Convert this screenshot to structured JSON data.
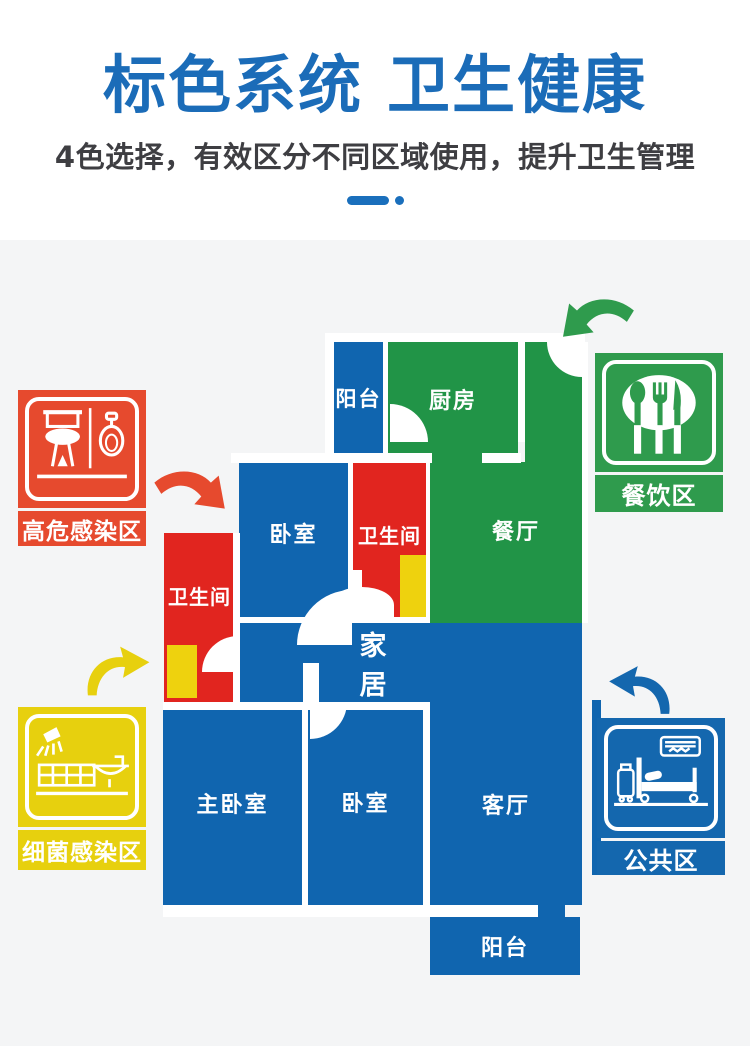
{
  "header": {
    "title": "标色系统 卫生健康",
    "subtitle": "4色选择，有效区分不同区域使用，提升卫生管理"
  },
  "colors": {
    "page_bg": "#ffffff",
    "section_bg": "#f4f5f6",
    "title_blue": "#1b6cb8",
    "subtitle_gray": "#3e3e42",
    "divider_blue": "#1a6fbc",
    "floor_blue": "#1065af",
    "floor_green": "#219447",
    "floor_red": "#e1251f",
    "floor_yellow": "#eed20e",
    "badge_red": "#e64a2e",
    "badge_green": "#2f9b4d",
    "badge_blue": "#1467ae",
    "badge_yellow": "#e7d00e",
    "wall_white": "#ffffff"
  },
  "floorplan": {
    "rooms": {
      "balcony_top": {
        "label": "阳台"
      },
      "kitchen": {
        "label": "厨房"
      },
      "dining": {
        "label": "餐厅"
      },
      "bedroom_top": {
        "label": "卧室"
      },
      "bathroom_right": {
        "label": "卫生间"
      },
      "bathroom_left": {
        "label": "卫生间"
      },
      "hall": {
        "label": "家居"
      },
      "master_bedroom": {
        "label": "主卧室"
      },
      "bedroom_bottom": {
        "label": "卧室"
      },
      "living_room": {
        "label": "客厅"
      },
      "balcony_bottom": {
        "label": "阳台"
      }
    }
  },
  "legend": {
    "high_risk": {
      "label": "高危感染区",
      "icon": "toilet-urinal-icon"
    },
    "bacteria": {
      "label": "细菌感染区",
      "icon": "shower-sink-icon"
    },
    "dining": {
      "label": "餐饮区",
      "icon": "tableware-icon"
    },
    "public": {
      "label": "公共区",
      "icon": "bed-luggage-icon"
    }
  }
}
